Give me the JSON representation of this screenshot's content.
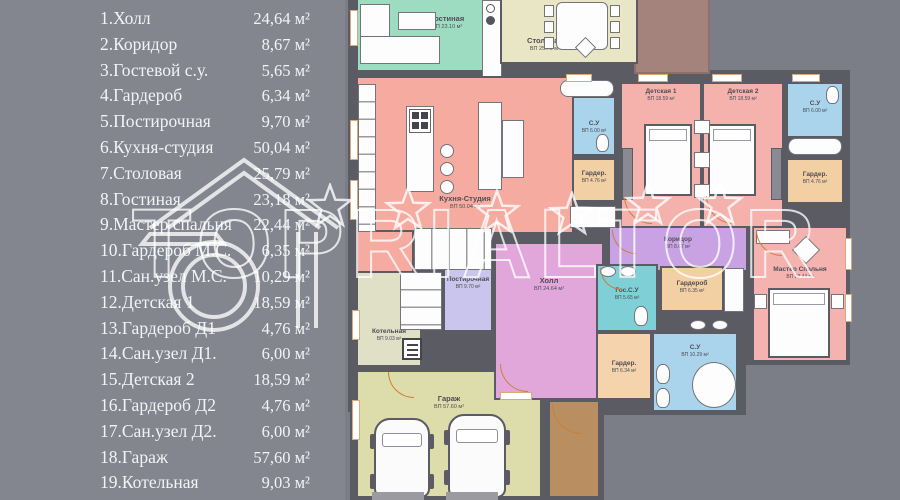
{
  "legend": {
    "rows": [
      {
        "label": "1.Холл",
        "area": "24,64 м²"
      },
      {
        "label": "2.Коридор",
        "area": "8,67 м²"
      },
      {
        "label": "3.Гостевой с.у.",
        "area": "5,65 м²"
      },
      {
        "label": "4.Гардероб",
        "area": "6,34 м²"
      },
      {
        "label": "5.Постирочная",
        "area": "9,70 м²"
      },
      {
        "label": "6.Кухня-студия",
        "area": "50,04 м²"
      },
      {
        "label": "7.Столовая",
        "area": "25,79 м²"
      },
      {
        "label": "8.Гостиная",
        "area": "23,18 м²"
      },
      {
        "label": "9.Мастер спальня",
        "area": "22,44 м²"
      },
      {
        "label": "10.Гардероб М.С.",
        "area": "6,35 м²"
      },
      {
        "label": "11.Сан.узел М.С.",
        "area": "10,29 м²"
      },
      {
        "label": "12.Детская 1",
        "area": "18,59 м²"
      },
      {
        "label": "13.Гардероб Д1",
        "area": "4,76 м²"
      },
      {
        "label": "14.Сан.узел Д1.",
        "area": "6,00 м²"
      },
      {
        "label": "15.Детская 2",
        "area": "18,59 м²"
      },
      {
        "label": "16.Гардероб Д2",
        "area": "4,76 м²"
      },
      {
        "label": "17.Сан.узел Д2.",
        "area": "6,00 м²"
      },
      {
        "label": "18.Гараж",
        "area": "57,60 м²"
      },
      {
        "label": "19.Котельная",
        "area": "9,03 м²"
      }
    ]
  },
  "plan": {
    "rooms": {
      "living": {
        "name": "Гостиная",
        "area": "ВП 23.10 м²"
      },
      "dining": {
        "name": "Столовая",
        "area": "ВП 25.79 м²"
      },
      "kitchen": {
        "name": "Кухня-Студия",
        "area": "ВП 50.04 м²"
      },
      "su_top_left": {
        "name": "С.У",
        "area": "ВП 6.00 м²"
      },
      "ward_top_left": {
        "name": "Гардер.",
        "area": "ВП 4.76 м²"
      },
      "child1": {
        "name": "Детская 1",
        "area": "ВП 18.59 м²"
      },
      "child2": {
        "name": "Детская 2",
        "area": "ВП 18.59 м²"
      },
      "su_top_right": {
        "name": "С.У",
        "area": "ВП 6.00 м²"
      },
      "ward_top_right": {
        "name": "Гардер.",
        "area": "ВП 4.76 м²"
      },
      "corridor": {
        "name": "Коридор",
        "area": "ВП 8.67 м²"
      },
      "master": {
        "name": "Мастер Спальня",
        "area": "ВП 22.44 м²"
      },
      "guest_su": {
        "name": "Гос.С.У",
        "area": "ВП 5.65 м²"
      },
      "ward_ms": {
        "name": "Гардероб",
        "area": "ВП 6.35 м²"
      },
      "su_ms": {
        "name": "С.У",
        "area": "ВП 10.29 м²"
      },
      "ward_hall": {
        "name": "Гардер.",
        "area": "ВП 6.34 м²"
      },
      "hall": {
        "name": "Холл",
        "area": "ВП 24.64 м²"
      },
      "laundry": {
        "name": "Постирочная",
        "area": "ВП 9.70 м²"
      },
      "boiler": {
        "name": "Котельная",
        "area": "ВП 9.03 м²"
      },
      "garage": {
        "name": "Гараж",
        "area": "ВП 57.60 м²"
      }
    }
  },
  "watermark": {
    "text": "TOPRIALTOR"
  },
  "palette": {
    "background_left": "#83868f",
    "background_right": "#7b7e87",
    "wall": "#5b5b63",
    "living": "#9edcc2",
    "dining": "#e9e6c5",
    "kitchen": "#f6aba1",
    "bedroom": "#f5b2ad",
    "bathroom": "#a9d4ec",
    "guest_bathroom": "#7fd0d6",
    "corridor": "#c9a2e3",
    "hall": "#e2a7da",
    "laundry": "#c9c5ec",
    "boiler": "#dfe0c5",
    "garage": "#dddcab",
    "wardrobe": "#f3cfa4",
    "entry": "#b98e61",
    "terrace": "#a3837b",
    "door_arc": "#c8803c",
    "legend_text": "#f2f3f6",
    "watermark": "#ffffff"
  }
}
